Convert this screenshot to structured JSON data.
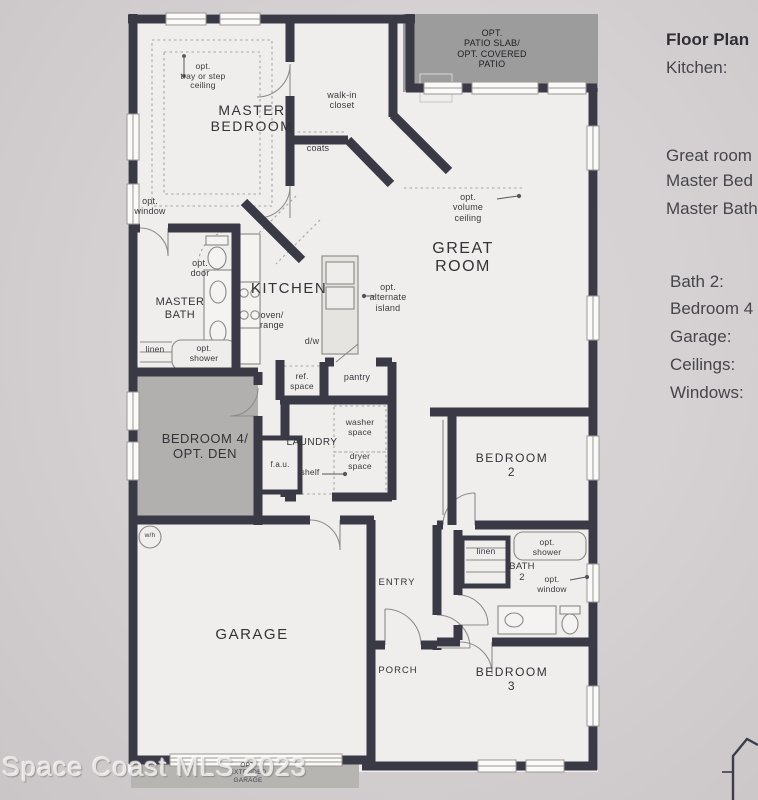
{
  "photo": {
    "watermark": "Space Coast MLS 2023"
  },
  "sidebar": {
    "title": "Floor Plan",
    "items": [
      "Kitchen:",
      "Great room",
      "Master Bed",
      "Master Bath",
      "Bath 2:",
      "Bedroom 4",
      "Garage:",
      "Ceilings:",
      "Windows:"
    ]
  },
  "plan": {
    "labels": {
      "master_bedroom": "MASTER\nBEDROOM",
      "opt_tray_ceiling": "opt.\ntray or step\nceiling",
      "walk_in_closet": "walk-in\ncloset",
      "coats": "coats",
      "opt_patio": "OPT.\nPATIO SLAB/\nOPT. COVERED\nPATIO",
      "opt_window_master": "opt.\nwindow",
      "master_bath": "MASTER\nBATH",
      "opt_door": "opt.\ndoor",
      "kitchen": "KITCHEN",
      "oven_range": "oven/\nrange",
      "dw": "d/w",
      "opt_alt_island": "opt.\nalternate\nisland",
      "opt_volume_ceiling": "opt.\nvolume\nceiling",
      "great_room": "GREAT\nROOM",
      "linen_master": "linen",
      "opt_shower_master": "opt.\nshower",
      "ref_space": "ref.\nspace",
      "pantry": "pantry",
      "bedroom4": "BEDROOM 4/\nOPT. DEN",
      "fau": "f.a.u.",
      "laundry": "LAUNDRY",
      "washer_space": "washer\nspace",
      "dryer_space": "dryer\nspace",
      "shelf": "shelf",
      "bedroom2": "BEDROOM\n2",
      "linen_bath2": "linen",
      "opt_shower_bath2": "opt.\nshower",
      "bath2": "BATH\n2",
      "opt_window_bath2": "opt.\nwindow",
      "entry": "ENTRY",
      "porch": "PORCH",
      "bedroom3": "BEDROOM\n3",
      "garage": "GARAGE",
      "water_heater": "w/h",
      "opt_extended_garage": "OPT.\nEXTENDED\nGARAGE"
    },
    "colors": {
      "wall": "#3a3a46",
      "patio_gray": "#9c9c9c",
      "optional_room_gray": "#b2b0ae",
      "paper": "#f0eeec",
      "photo_background": "#d5d1d3"
    }
  }
}
